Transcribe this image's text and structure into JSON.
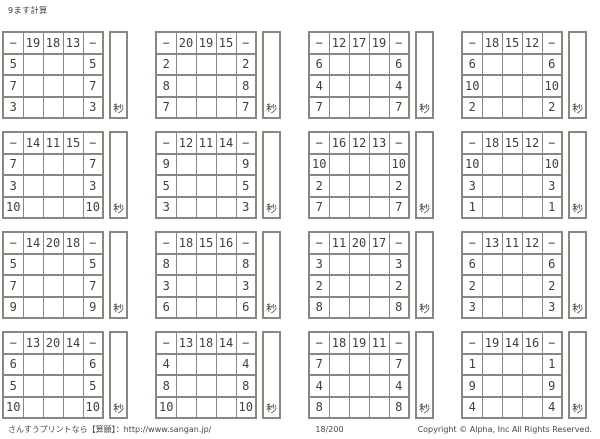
{
  "title": "9ます計算",
  "operator": "−",
  "seconds_label": "秒",
  "grids": [
    {
      "top": [
        "19",
        "18",
        "13"
      ],
      "left": [
        "5",
        "7",
        "3"
      ]
    },
    {
      "top": [
        "20",
        "19",
        "15"
      ],
      "left": [
        "2",
        "8",
        "7"
      ]
    },
    {
      "top": [
        "12",
        "17",
        "19"
      ],
      "left": [
        "6",
        "4",
        "7"
      ]
    },
    {
      "top": [
        "18",
        "15",
        "12"
      ],
      "left": [
        "6",
        "10",
        "2"
      ]
    },
    {
      "top": [
        "14",
        "11",
        "15"
      ],
      "left": [
        "7",
        "3",
        "10"
      ]
    },
    {
      "top": [
        "12",
        "11",
        "14"
      ],
      "left": [
        "9",
        "5",
        "3"
      ]
    },
    {
      "top": [
        "16",
        "12",
        "13"
      ],
      "left": [
        "10",
        "2",
        "7"
      ]
    },
    {
      "top": [
        "18",
        "15",
        "12"
      ],
      "left": [
        "10",
        "3",
        "1"
      ]
    },
    {
      "top": [
        "14",
        "20",
        "18"
      ],
      "left": [
        "5",
        "7",
        "9"
      ]
    },
    {
      "top": [
        "18",
        "15",
        "16"
      ],
      "left": [
        "8",
        "3",
        "6"
      ]
    },
    {
      "top": [
        "11",
        "20",
        "17"
      ],
      "left": [
        "3",
        "2",
        "8"
      ]
    },
    {
      "top": [
        "13",
        "11",
        "12"
      ],
      "left": [
        "6",
        "2",
        "3"
      ]
    },
    {
      "top": [
        "13",
        "20",
        "14"
      ],
      "left": [
        "6",
        "5",
        "10"
      ]
    },
    {
      "top": [
        "13",
        "18",
        "14"
      ],
      "left": [
        "4",
        "8",
        "10"
      ]
    },
    {
      "top": [
        "18",
        "19",
        "11"
      ],
      "left": [
        "7",
        "4",
        "8"
      ]
    },
    {
      "top": [
        "19",
        "14",
        "16"
      ],
      "left": [
        "1",
        "9",
        "4"
      ]
    }
  ],
  "footer": {
    "site": "さんすうプリントなら【算願】：http://www.sangan.jp/",
    "page": "18/200",
    "copyright": "Copyright © Alpha, Inc All Rights Reserved."
  }
}
